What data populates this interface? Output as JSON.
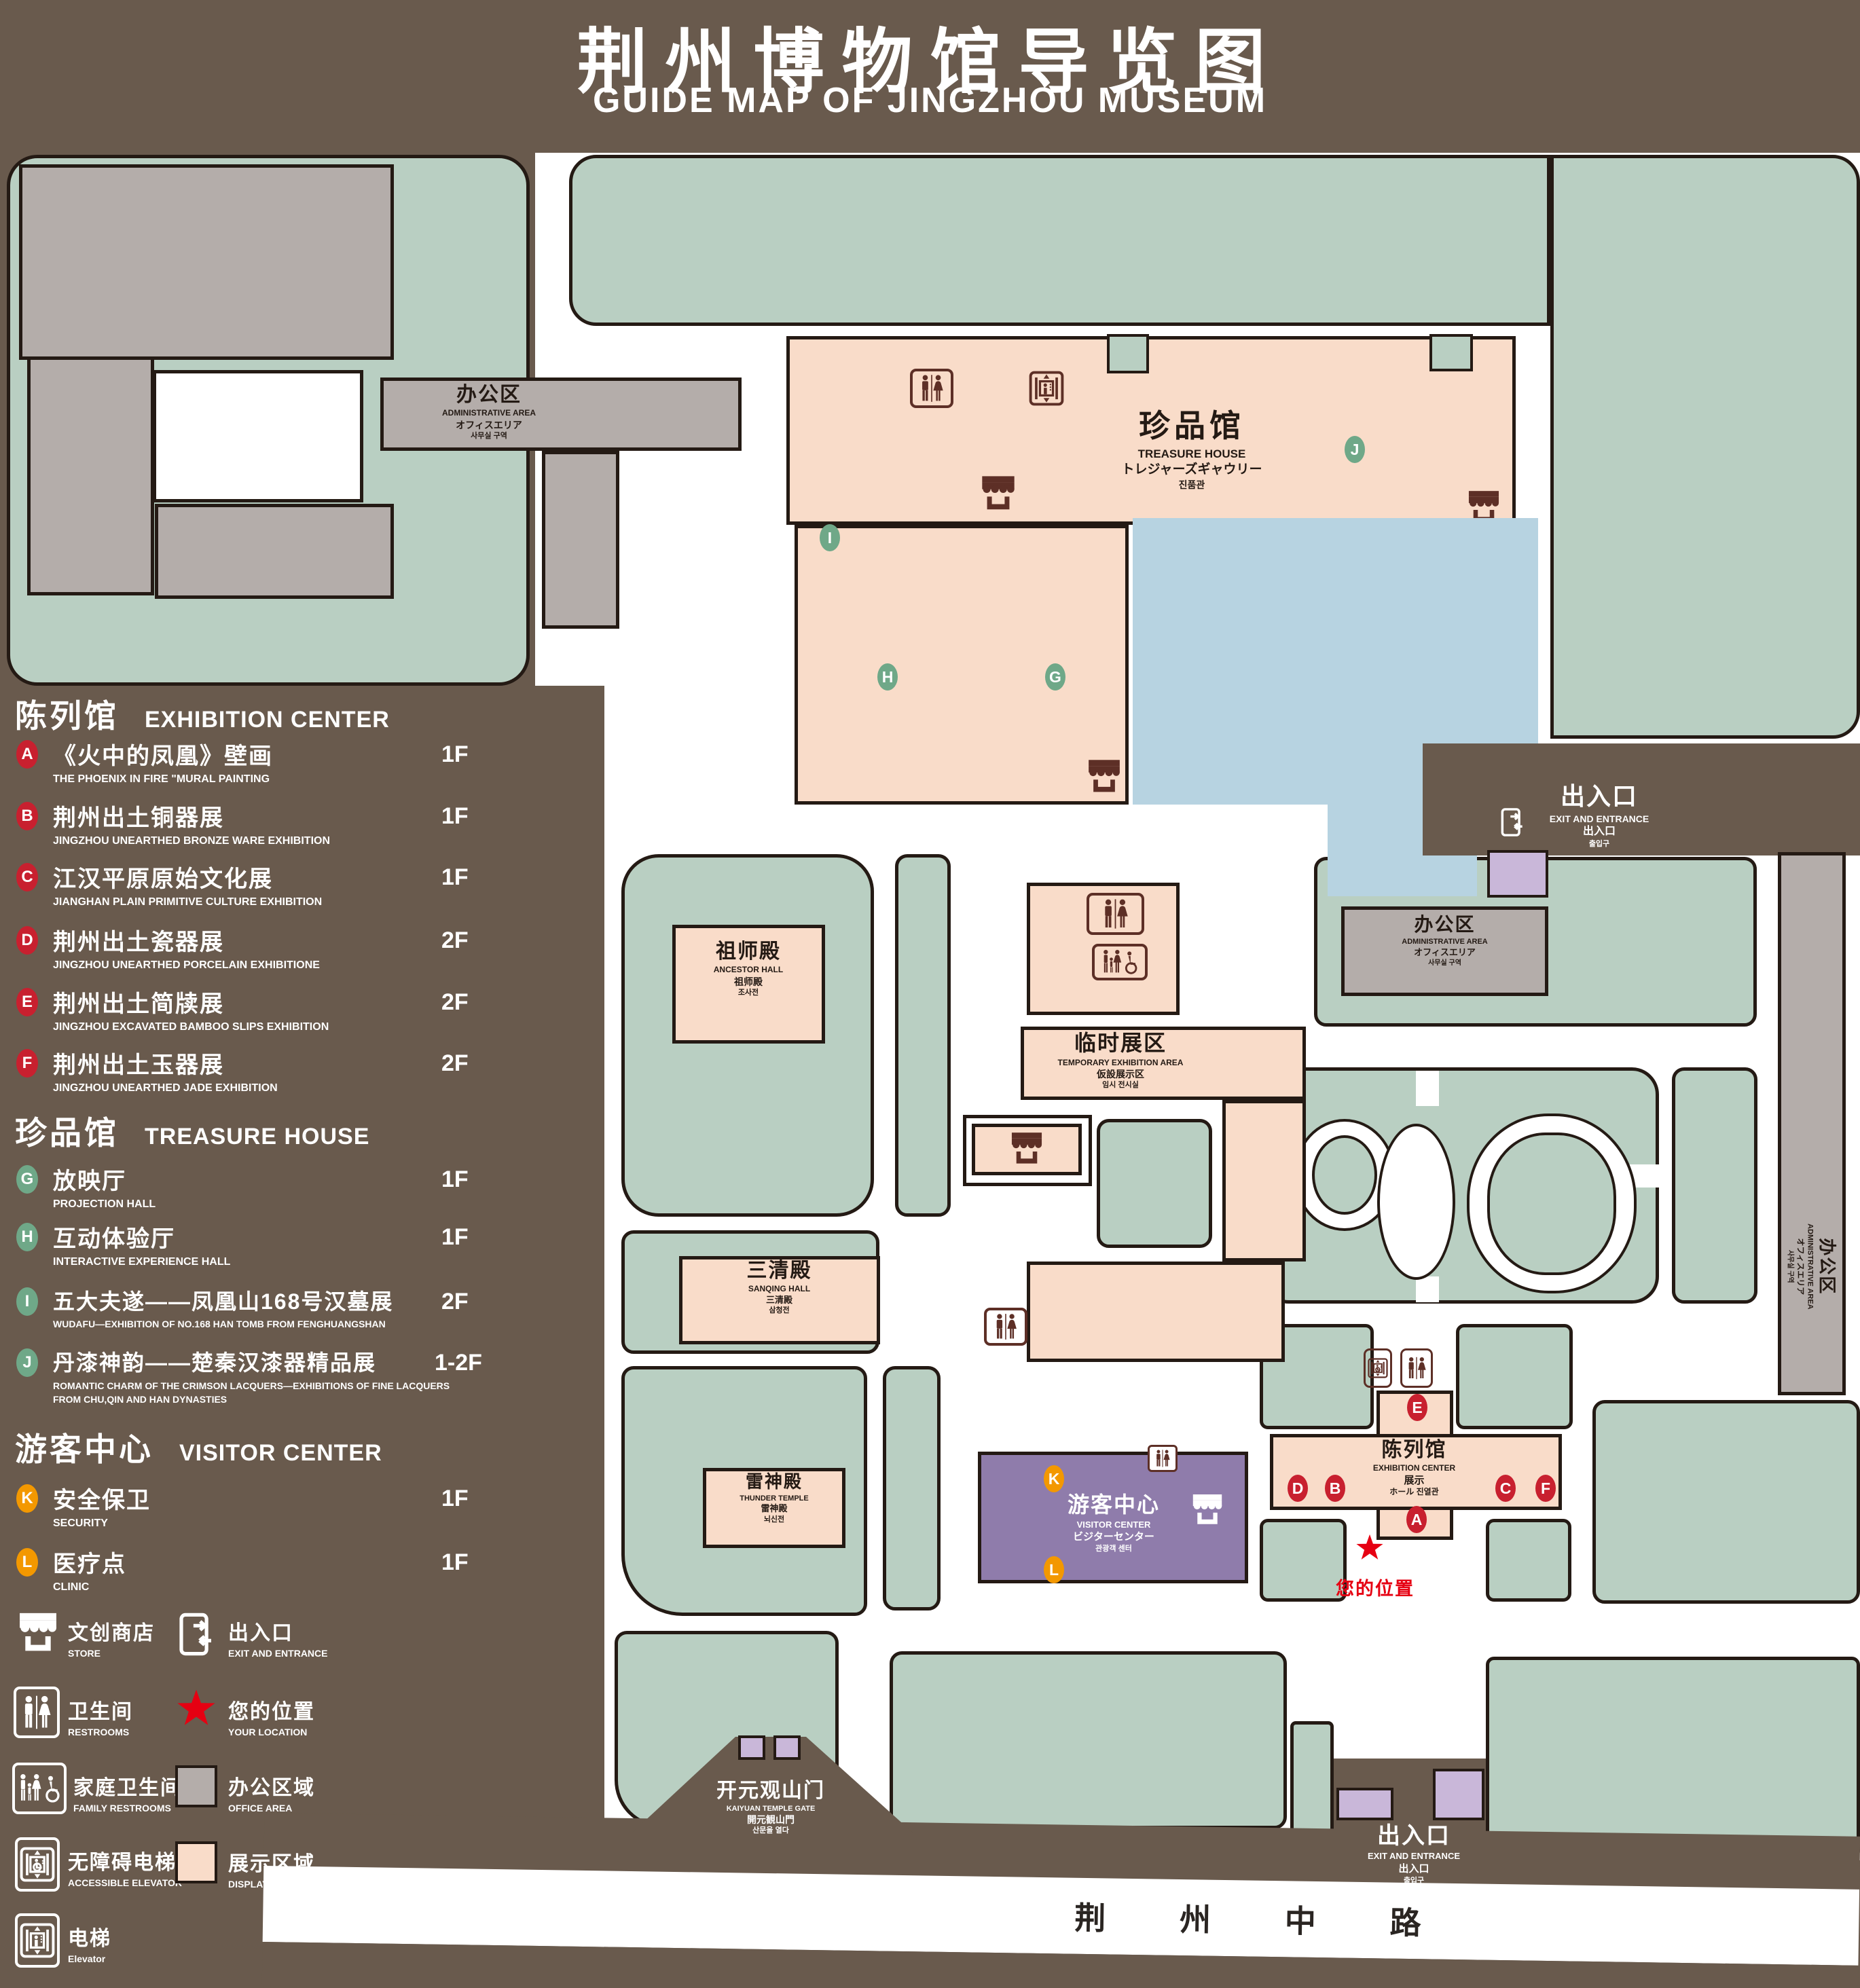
{
  "title": {
    "zh": "荆州博物馆导览图",
    "en": "GUIDE MAP OF JINGZHOU MUSEUM"
  },
  "legend": {
    "sections": [
      {
        "title_zh": "陈列馆",
        "title_en": "EXHIBITION CENTER",
        "items": [
          {
            "id": "A",
            "zh": "《火中的凤凰》壁画",
            "en": "THE PHOENIX IN FIRE \"MURAL PAINTING",
            "floor": "1F"
          },
          {
            "id": "B",
            "zh": "荆州出土铜器展",
            "en": "JINGZHOU UNEARTHED BRONZE WARE EXHIBITION",
            "floor": "1F"
          },
          {
            "id": "C",
            "zh": "江汉平原原始文化展",
            "en": "JIANGHAN PLAIN PRIMITIVE CULTURE EXHIBITION",
            "floor": "1F"
          },
          {
            "id": "D",
            "zh": "荆州出土瓷器展",
            "en": "JINGZHOU UNEARTHED PORCELAIN EXHIBITIONE",
            "floor": "2F"
          },
          {
            "id": "E",
            "zh": "荆州出土简牍展",
            "en": "JINGZHOU EXCAVATED BAMBOO SLIPS EXHIBITION",
            "floor": "2F"
          },
          {
            "id": "F",
            "zh": "荆州出土玉器展",
            "en": "JINGZHOU UNEARTHED JADE EXHIBITION",
            "floor": "2F"
          }
        ]
      },
      {
        "title_zh": "珍品馆",
        "title_en": "TREASURE HOUSE",
        "items": [
          {
            "id": "G",
            "zh": "放映厅",
            "en": "PROJECTION HALL",
            "floor": "1F"
          },
          {
            "id": "H",
            "zh": "互动体验厅",
            "en": "INTERACTIVE EXPERIENCE HALL",
            "floor": "1F"
          },
          {
            "id": "I",
            "zh": "五大夫遂——凤凰山168号汉墓展",
            "en": "WUDAFU—EXHIBITION OF NO.168 HAN TOMB FROM FENGHUANGSHAN",
            "floor": "2F"
          },
          {
            "id": "J",
            "zh": "丹漆神韵——楚秦汉漆器精品展",
            "en": "ROMANTIC CHARM OF THE CRIMSON LACQUERS—EXHIBITIONS OF FINE LACQUERS FROM CHU,QIN AND HAN DYNASTIES",
            "floor": "1-2F"
          }
        ]
      },
      {
        "title_zh": "游客中心",
        "title_en": "VISITOR CENTER",
        "items": [
          {
            "id": "K",
            "zh": "安全保卫",
            "en": "SECURITY",
            "floor": "1F"
          },
          {
            "id": "L",
            "zh": "医疗点",
            "en": "CLINIC",
            "floor": "1F"
          }
        ]
      }
    ],
    "symbols_left": [
      {
        "zh": "文创商店",
        "en": "STORE"
      },
      {
        "zh": "卫生间",
        "en": "RESTROOMS"
      },
      {
        "zh": "家庭卫生间",
        "en": "FAMILY RESTROOMS"
      },
      {
        "zh": "无障碍电梯",
        "en": "ACCESSIBLE ELEVATOR"
      },
      {
        "zh": "电梯",
        "en": "Elevator"
      }
    ],
    "symbols_right": [
      {
        "zh": "出入口",
        "en": "EXIT AND ENTRANCE"
      },
      {
        "zh": "您的位置",
        "en": "YOUR LOCATION"
      },
      {
        "zh": "办公区域",
        "en": "OFFICE AREA"
      },
      {
        "zh": "展示区域",
        "en": "DISPLAY AREA"
      }
    ]
  },
  "map": {
    "admin": {
      "zh": "办公区",
      "en": "ADMINISTRATIVE AREA",
      "ja": "オフィスエリア",
      "ko": "사무실 구역"
    },
    "treasure_house": {
      "zh": "珍品馆",
      "en": "TREASURE HOUSE",
      "ja": "トレジャーズギャウリー",
      "ko": "진품관"
    },
    "ancestor_hall": {
      "zh": "祖师殿",
      "en": "ANCESTOR HALL",
      "ja": "祖师殿",
      "ko": "조사전"
    },
    "temporary_area": {
      "zh": "临时展区",
      "en": "TEMPORARY EXHIBITION AREA",
      "ja": "仮設展示区",
      "ko": "임시 전시실"
    },
    "sanqing_hall": {
      "zh": "三清殿",
      "en": "SANQING HALL",
      "ja": "三清殿",
      "ko": "삼청전"
    },
    "thunder_temple": {
      "zh": "雷神殿",
      "en": "THUNDER TEMPLE",
      "ja": "雷神殿",
      "ko": "뇌신전"
    },
    "visitor_center": {
      "zh": "游客中心",
      "en": "VISITOR CENTER",
      "ja": "ビジターセンター",
      "ko": "관광객 센터"
    },
    "exhibition_center": {
      "zh": "陈列馆",
      "en": "EXHIBITION CENTER",
      "ja": "展示",
      "ko": "ホール 진열관"
    },
    "gate": {
      "zh": "开元观山门",
      "en": "KAIYUAN TEMPLE GATE",
      "ja": "開元観山門",
      "ko": "산문을 열다"
    },
    "exit": {
      "zh": "出入口",
      "en": "EXIT AND ENTRANCE",
      "ja": "出入口",
      "ko": "출입구"
    },
    "road": "荆 州 中 路",
    "your_location": "您的位置",
    "markers": {
      "A": "A",
      "B": "B",
      "C": "C",
      "D": "D",
      "E": "E",
      "F": "F",
      "G": "G",
      "H": "H",
      "I": "I",
      "J": "J",
      "K": "K",
      "L": "L"
    }
  },
  "colors": {
    "background": "#695a4d",
    "grass": "#b9cfc2",
    "display_area": "#f9dcc9",
    "office_area": "#b4adaa",
    "pond": "#b7d3e1",
    "visitor_purple": "#8f7cab",
    "gate_purple": "#c9b7d9",
    "marker_red": "#c8202f",
    "marker_green": "#6fa888",
    "marker_orange": "#f39800",
    "location_red": "#e60012",
    "icon_brown": "#5d2f26"
  }
}
